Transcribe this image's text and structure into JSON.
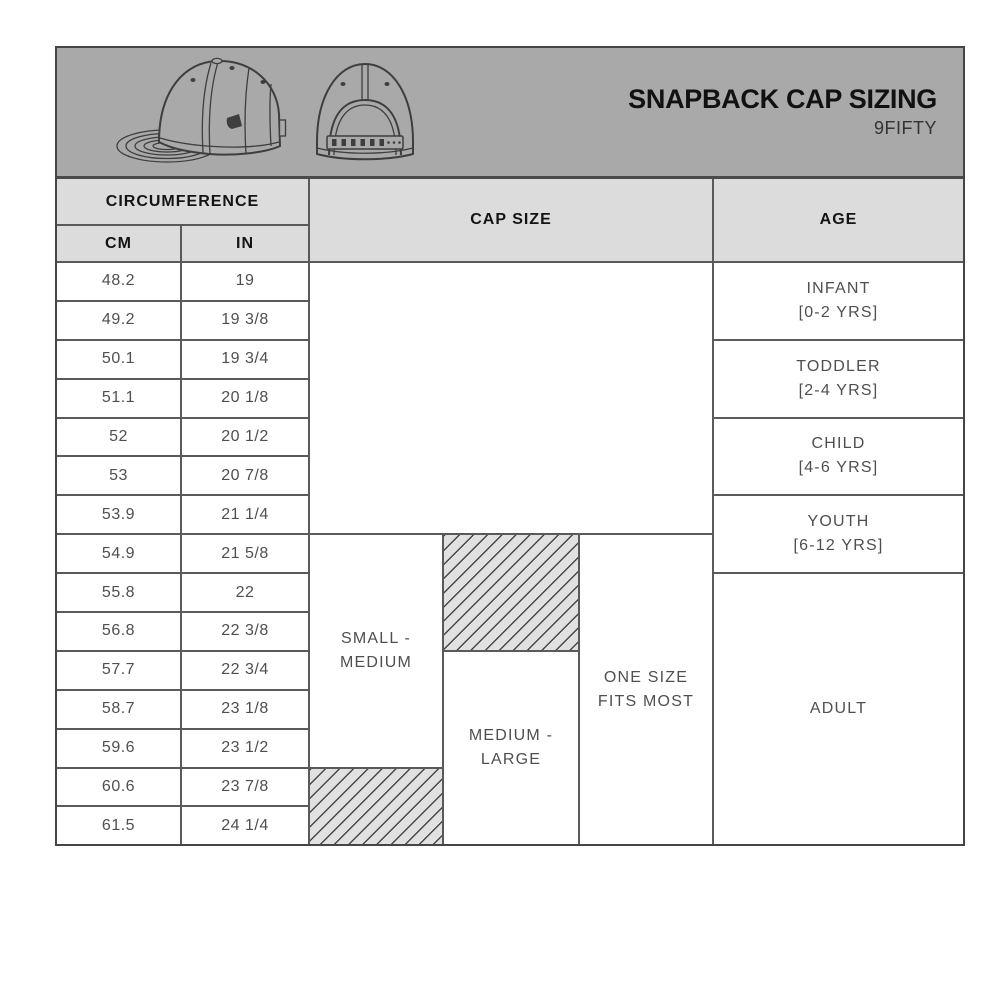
{
  "figure": {
    "title": "SNAPBACK CAP SIZING",
    "subtitle": "9FIFTY",
    "illustrations": [
      {
        "name": "snapback-cap-side-view"
      },
      {
        "name": "snapback-cap-back-view"
      }
    ]
  },
  "table": {
    "headers": {
      "circumference": "CIRCUMFERENCE",
      "cm": "CM",
      "in": "IN",
      "cap_size": "CAP SIZE",
      "age": "AGE"
    },
    "rows": [
      {
        "cm": "48.2",
        "in": "19"
      },
      {
        "cm": "49.2",
        "in": "19 3/8"
      },
      {
        "cm": "50.1",
        "in": "19 3/4"
      },
      {
        "cm": "51.1",
        "in": "20 1/8"
      },
      {
        "cm": "52",
        "in": "20 1/2"
      },
      {
        "cm": "53",
        "in": "20 7/8"
      },
      {
        "cm": "53.9",
        "in": "21 1/4"
      },
      {
        "cm": "54.9",
        "in": "21 5/8"
      },
      {
        "cm": "55.8",
        "in": "22"
      },
      {
        "cm": "56.8",
        "in": "22 3/8"
      },
      {
        "cm": "57.7",
        "in": "22 3/4"
      },
      {
        "cm": "58.7",
        "in": "23 1/8"
      },
      {
        "cm": "59.6",
        "in": "23 1/2"
      },
      {
        "cm": "60.6",
        "in": "23 7/8"
      },
      {
        "cm": "61.5",
        "in": "24 1/4"
      }
    ],
    "cap_boxes": [
      {
        "line1": "SMALL -",
        "line2": "MEDIUM"
      },
      {
        "line1": "MEDIUM -",
        "line2": "LARGE"
      },
      {
        "line1": "ONE SIZE",
        "line2": "FITS MOST"
      }
    ],
    "age_groups": [
      {
        "line1": "INFANT",
        "line2": "[0-2 YRS]"
      },
      {
        "line1": "TODDLER",
        "line2": "[2-4 YRS]"
      },
      {
        "line1": "CHILD",
        "line2": "[4-6 YRS]"
      },
      {
        "line1": "YOUTH",
        "line2": "[6-12 YRS]"
      },
      {
        "line1": "ADULT",
        "line2": ""
      }
    ]
  },
  "colors": {
    "band_gray": "#a9a9a9",
    "header_cell_gray": "#dcdcdc",
    "grid_line": "#5a5a5a",
    "outer_border": "#454545",
    "hatch_background": "#e1e1e1",
    "hatch_line": "#474747",
    "title_text": "#111111",
    "body_text": "#4f4f4f"
  },
  "chart_data": {
    "type": "table",
    "title": "SNAPBACK CAP SIZING",
    "subtitle": "9FIFTY",
    "columns": [
      "CIRCUMFERENCE CM",
      "CIRCUMFERENCE IN",
      "CAP SIZE",
      "AGE"
    ],
    "circumference_rows": [
      [
        "48.2",
        "19"
      ],
      [
        "49.2",
        "19 3/8"
      ],
      [
        "50.1",
        "19 3/4"
      ],
      [
        "51.1",
        "20 1/8"
      ],
      [
        "52",
        "20 1/2"
      ],
      [
        "53",
        "20 7/8"
      ],
      [
        "53.9",
        "21 1/4"
      ],
      [
        "54.9",
        "21 5/8"
      ],
      [
        "55.8",
        "22"
      ],
      [
        "56.8",
        "22 3/8"
      ],
      [
        "57.7",
        "22 3/4"
      ],
      [
        "58.7",
        "23 1/8"
      ],
      [
        "59.6",
        "23 1/2"
      ],
      [
        "60.6",
        "23 7/8"
      ],
      [
        "61.5",
        "24 1/4"
      ]
    ],
    "cap_size_ranges": [
      {
        "label": "SMALL - MEDIUM",
        "solid_cm": [
          "54.9",
          "59.6"
        ],
        "hatched_cm": [
          "60.6",
          "61.5"
        ]
      },
      {
        "label": "MEDIUM - LARGE",
        "solid_cm": [
          "57.7",
          "61.5"
        ],
        "hatched_cm": [
          "54.9",
          "56.8"
        ]
      },
      {
        "label": "ONE SIZE FITS MOST",
        "solid_cm": [
          "54.9",
          "61.5"
        ],
        "hatched_cm": null
      }
    ],
    "age_ranges": [
      {
        "label": "INFANT [0-2 YRS]",
        "cm": [
          "48.2",
          "49.2"
        ]
      },
      {
        "label": "TODDLER [2-4 YRS]",
        "cm": [
          "50.1",
          "51.1"
        ]
      },
      {
        "label": "CHILD [4-6 YRS]",
        "cm": [
          "52",
          "53"
        ]
      },
      {
        "label": "YOUTH [6-12 YRS]",
        "cm": [
          "53.9",
          "54.9"
        ]
      },
      {
        "label": "ADULT",
        "cm": [
          "55.8",
          "61.5"
        ]
      }
    ]
  }
}
